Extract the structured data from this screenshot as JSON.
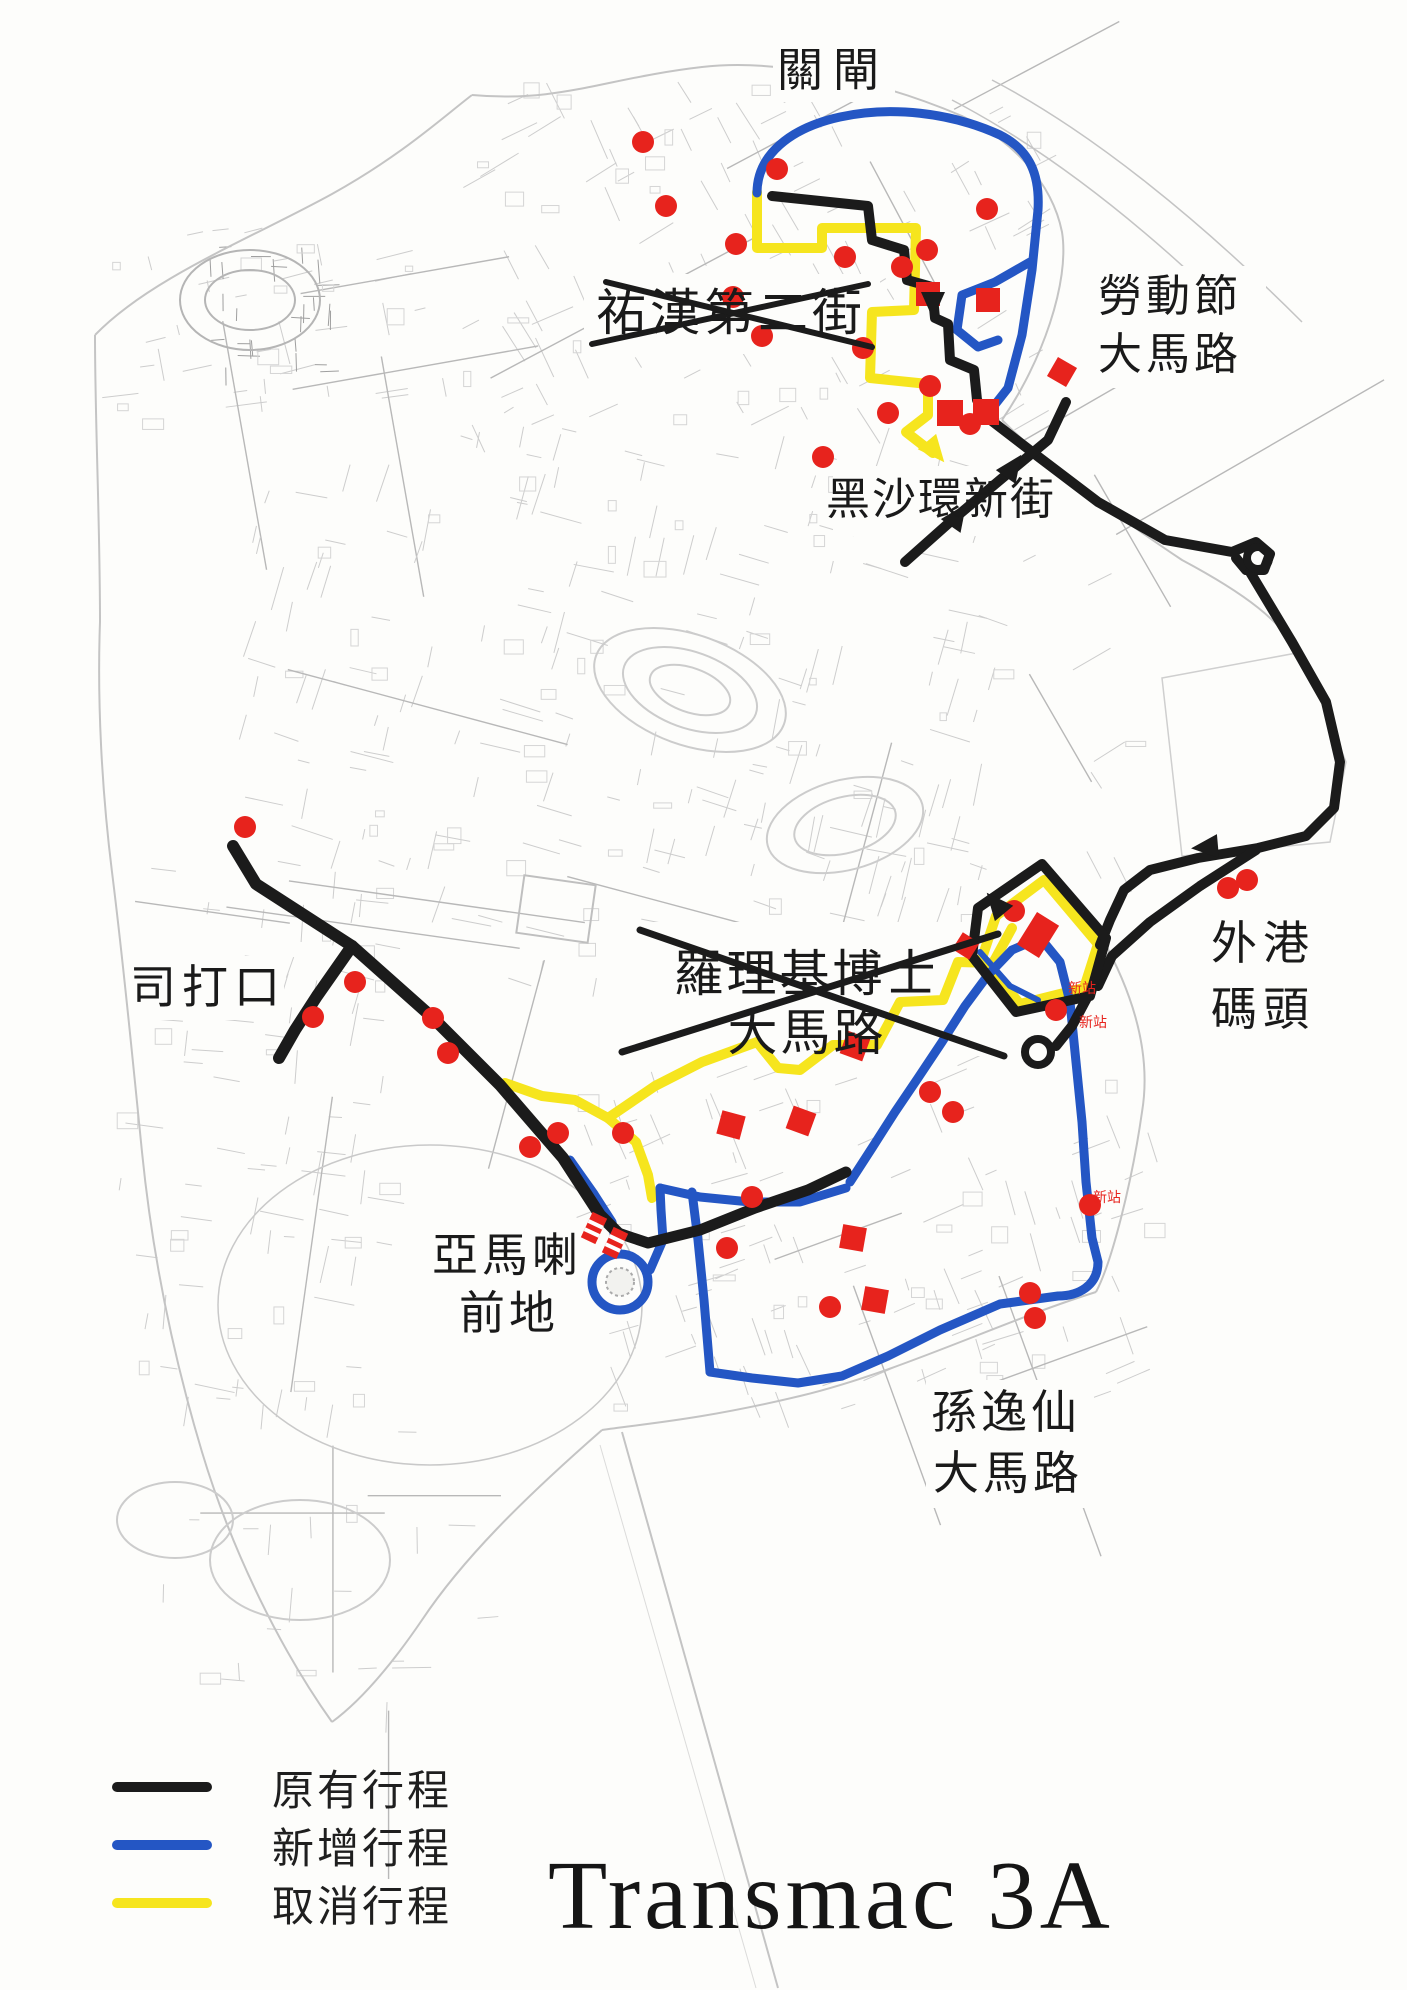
{
  "title": {
    "text": "Transmac 3A"
  },
  "legend": {
    "items": [
      {
        "id": "original",
        "label": "原有行程",
        "color": "#1b1b1b"
      },
      {
        "id": "new",
        "label": "新增行程",
        "color": "#2456c4"
      },
      {
        "id": "cancelled",
        "label": "取消行程",
        "color": "#f6e51e"
      }
    ]
  },
  "map": {
    "stop_color": "#e7231d",
    "labels": {
      "border_gate": "關閘",
      "iau_hon_second_street": "祐漢第二街",
      "labour_day_line1": "勞動節",
      "labour_day_line2": "大馬路",
      "hac_sa_wan_new_street": "黑沙環新街",
      "outer_harbour_line1": "外港",
      "outer_harbour_line2": "碼頭",
      "rodrigues_line1": "羅理基博士",
      "rodrigues_line2": "大馬路",
      "praca_ponte_horta": "司打口",
      "amagao_line1": "亞馬喇",
      "amagao_line2": "前地",
      "sun_yat_sen_line1": "孫逸仙",
      "sun_yat_sen_line2": "大馬路",
      "new_stop": "新站"
    }
  }
}
